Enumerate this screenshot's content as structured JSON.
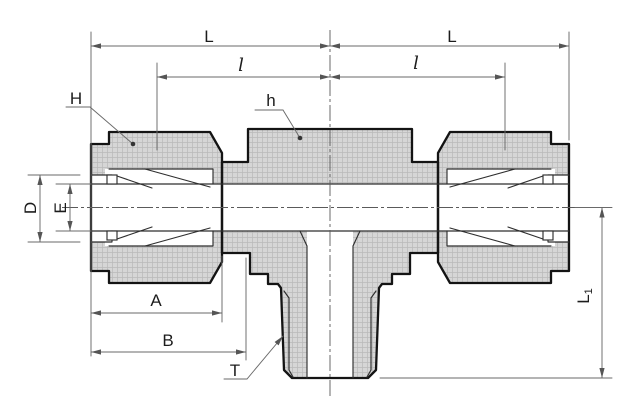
{
  "drawing": {
    "description_labels_only": "technical dimension drawing of a male branch tee tube fitting",
    "colors": {
      "background": "#ffffff",
      "metal_fill": "#d6d6d6",
      "outline": "#141414",
      "internal_line": "#2e2e2e",
      "dimension_line": "#6a6a6a",
      "text": "#1c1c1c"
    },
    "dims": {
      "L_left": "L",
      "L_right": "L",
      "l_left": "l",
      "l_right": "l",
      "H": "H",
      "h": "h",
      "D": "D",
      "E": "E",
      "A": "A",
      "B": "B",
      "T": "T",
      "L1_base": "L",
      "L1_sub": "1"
    }
  }
}
